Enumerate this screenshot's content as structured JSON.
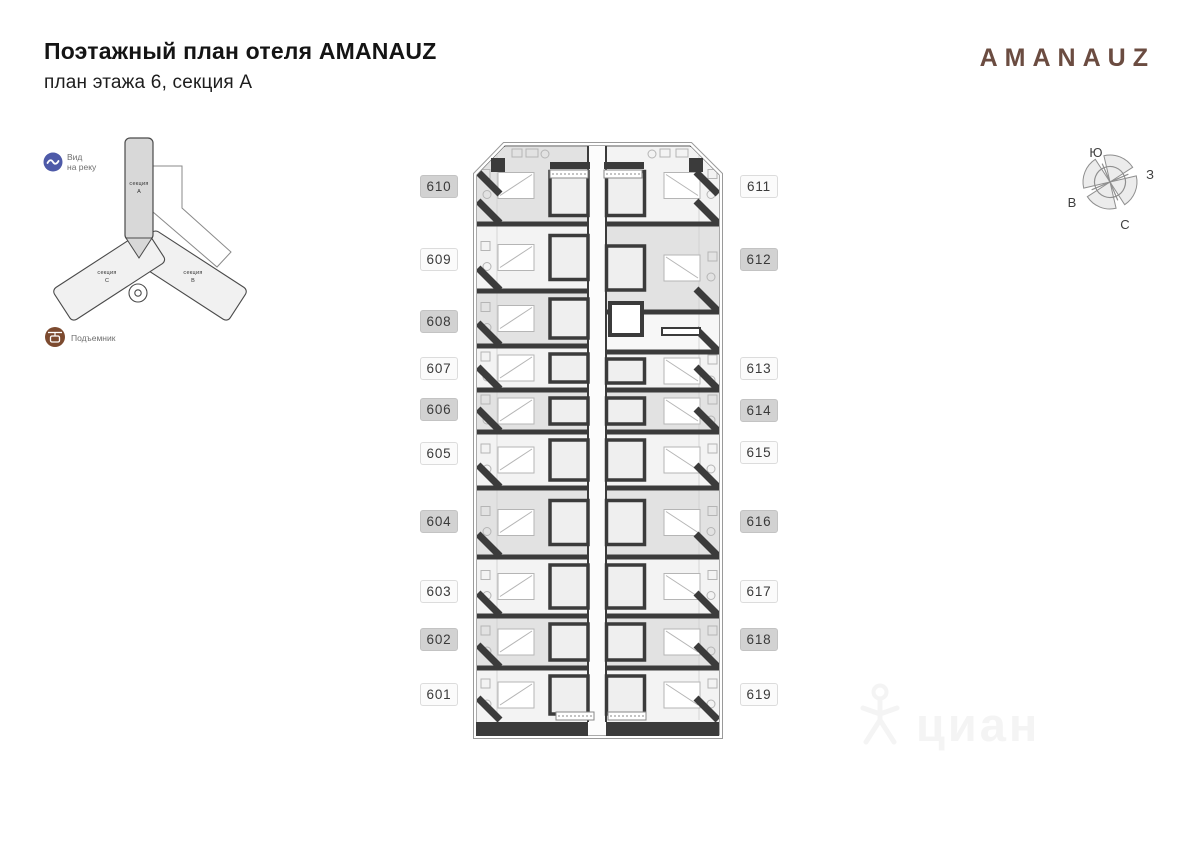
{
  "header": {
    "title": "Поэтажный план отеля AMANAUZ",
    "subtitle": "план этажа 6, секция А"
  },
  "brand": {
    "logo_text": "AMANAUZ",
    "logo_color": "#6b4c41"
  },
  "legend": {
    "river_view": {
      "icon": "wave-icon",
      "icon_color": "#4e5aa8",
      "line1": "Вид",
      "line2": "на реку"
    },
    "lift": {
      "icon": "gondola-icon",
      "icon_color": "#7c4a2f",
      "label": "Подъемник"
    }
  },
  "overview": {
    "sections": [
      {
        "id": "A",
        "line1": "секция",
        "line2": "А",
        "highlighted": true
      },
      {
        "id": "C",
        "line1": "секция",
        "line2": "С",
        "highlighted": false
      },
      {
        "id": "B",
        "line1": "секция",
        "line2": "В",
        "highlighted": false
      }
    ]
  },
  "compass": {
    "top": "Ю",
    "right": "З",
    "left": "В",
    "bottom": "С"
  },
  "plan": {
    "rooms_left": [
      "610",
      "609",
      "608",
      "607",
      "606",
      "605",
      "604",
      "603",
      "602",
      "601"
    ],
    "rooms_right": [
      "611",
      "612",
      "613",
      "614",
      "615",
      "616",
      "617",
      "618",
      "619"
    ],
    "wall_color": "#3b3b3b",
    "room_shaded_color": "#e2e2e2",
    "room_light_color": "#f3f3f3"
  },
  "watermark": {
    "icon": "person-icon",
    "text": "циан"
  }
}
